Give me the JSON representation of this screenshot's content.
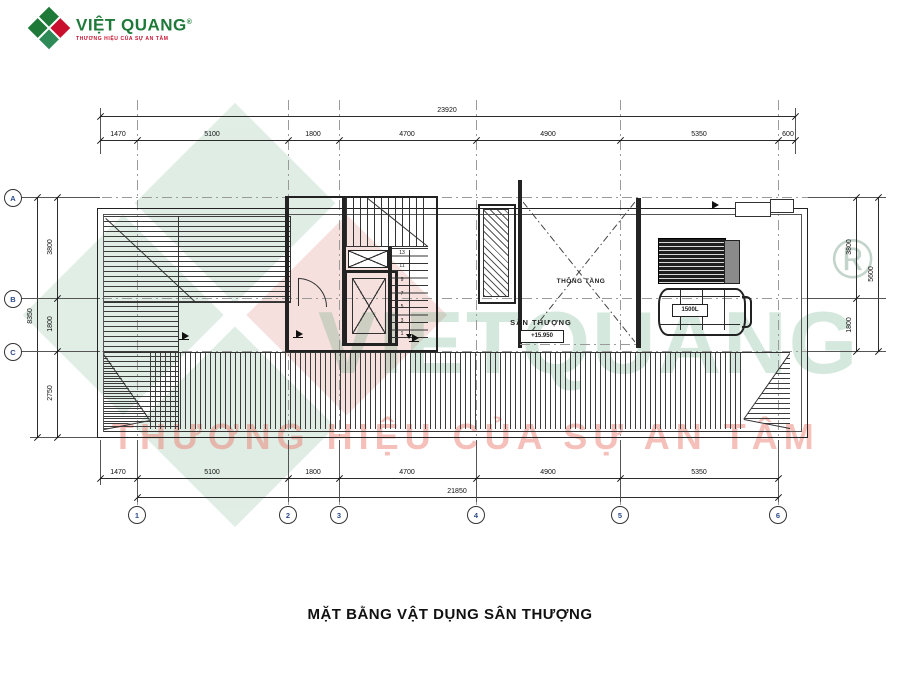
{
  "logo": {
    "brand": "VIỆT QUANG",
    "registered": "®",
    "tagline": "THƯƠNG HIỆU CỦA SỰ AN TÂM",
    "colors": {
      "green": "#1f7a3a",
      "red": "#c8102e"
    }
  },
  "title": "MẶT BẰNG VẬT DỤNG SÂN THƯỢNG",
  "plan": {
    "labels": {
      "terrace": "SÂN THƯỢNG",
      "terrace_elevation": "+15.950",
      "void": "THÔNG TẦNG",
      "water_tank": "1500L"
    },
    "stair_numbers": [
      "13",
      "11",
      "9",
      "7",
      "5",
      "3",
      "1"
    ],
    "grid": {
      "columns": [
        "1",
        "2",
        "3",
        "4",
        "5",
        "6"
      ],
      "rows": [
        "A",
        "B",
        "C"
      ]
    },
    "dimensions": {
      "top_total": "23920",
      "top_segments": [
        "1470",
        "5100",
        "1800",
        "4700",
        "4900",
        "5350",
        "600"
      ],
      "bottom_segments": [
        "1470",
        "5100",
        "1800",
        "4700",
        "4900",
        "5350"
      ],
      "bottom_total": "21850",
      "left_segments": [
        "3800",
        "1800",
        "2750"
      ],
      "left_total": "8350",
      "right_segments": [
        "3800",
        "1800"
      ],
      "right_total": "5600"
    }
  },
  "watermark": {
    "text": "VIETQUANG",
    "registered": "®",
    "tagline": "THƯƠNG HIỆU CỦA SỰ AN TÂM"
  }
}
